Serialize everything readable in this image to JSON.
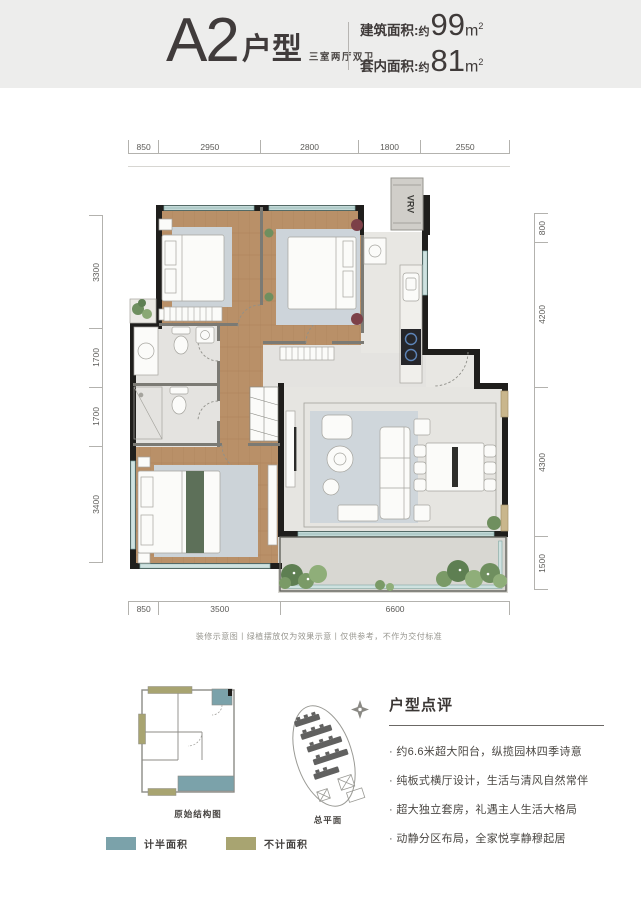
{
  "header": {
    "title": "A2",
    "title_suffix": "户型",
    "subtitle": "三室两厅双卫",
    "areas": [
      {
        "label": "建筑面积:",
        "approx": "约",
        "value": "99",
        "unit": "m",
        "power": "2"
      },
      {
        "label": "套内面积:",
        "approx": "约",
        "value": "81",
        "unit": "m",
        "power": "2"
      }
    ]
  },
  "plan": {
    "vrv_label": "VRV",
    "dims": {
      "top": [
        "850",
        "2950",
        "2800",
        "1800",
        "2550"
      ],
      "left": [
        "3300",
        "1700",
        "1700",
        "3400"
      ],
      "right": [
        "800",
        "4200",
        "4300",
        "1500"
      ],
      "bottom": [
        "850",
        "3500",
        "6600"
      ]
    }
  },
  "disclaimer": "装修示意图丨绿植摆放仅为效果示意丨仅供参考，不作为交付标准",
  "footer": {
    "structural_label": "原始结构图",
    "siteplan_label": "总平面",
    "legend": [
      {
        "label": "计半面积",
        "color": "#7ba2aa"
      },
      {
        "label": "不计面积",
        "color": "#a8a471"
      }
    ],
    "review": {
      "title": "户型点评",
      "bullets": [
        "· 约6.6米超大阳台，纵揽园林四季诗意",
        "· 纯板式横厅设计，生活与清风自然常伴",
        "· 超大独立套房，礼遇主人生活大格局",
        "· 动静分区布局，全家悦享静穆起居"
      ]
    }
  },
  "colors": {
    "header_bg": "#ededec",
    "wall": "#1f1e1c",
    "wood_floor": "#b99068",
    "marble_floor": "#e4e3e0",
    "window": "#cfe2e0",
    "legend_half_area": "#7ba2aa",
    "legend_excluded_area": "#a8a471"
  }
}
